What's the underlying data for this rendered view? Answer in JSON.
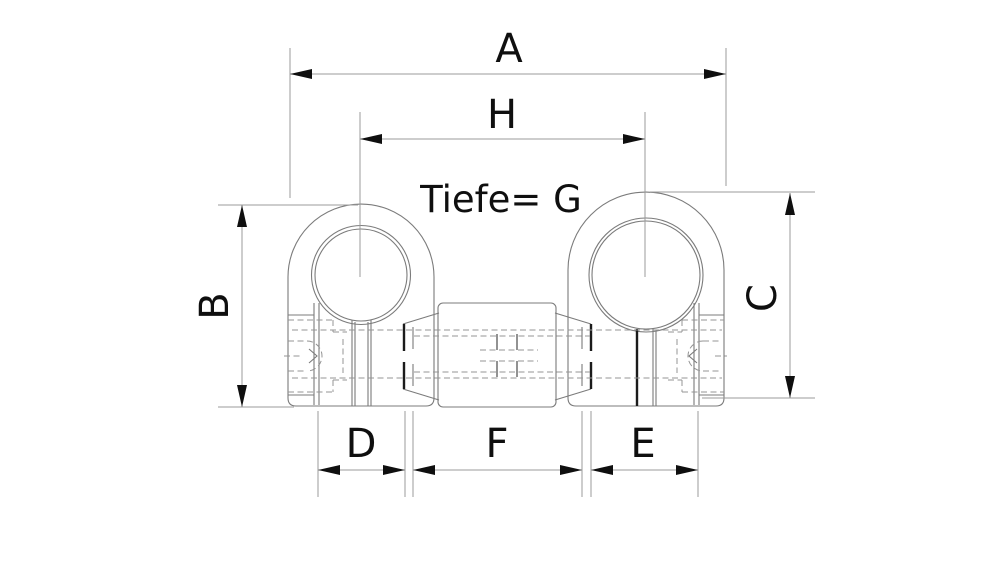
{
  "drawing": {
    "background_color": "#ffffff",
    "outline_color": "#7b7b7b",
    "hidden_line_color": "#949494",
    "dimension_line_color": "#9b9b9b",
    "thick_edge_color": "#1b1b1b",
    "joint_line_color": "#4a4a4a",
    "text_color": "#0f0f0f",
    "depth_note": "Tiefe= G",
    "dimension_labels": {
      "a": "A",
      "h": "H",
      "b": "B",
      "c": "C",
      "d": "D",
      "f": "F",
      "e": "E"
    }
  }
}
